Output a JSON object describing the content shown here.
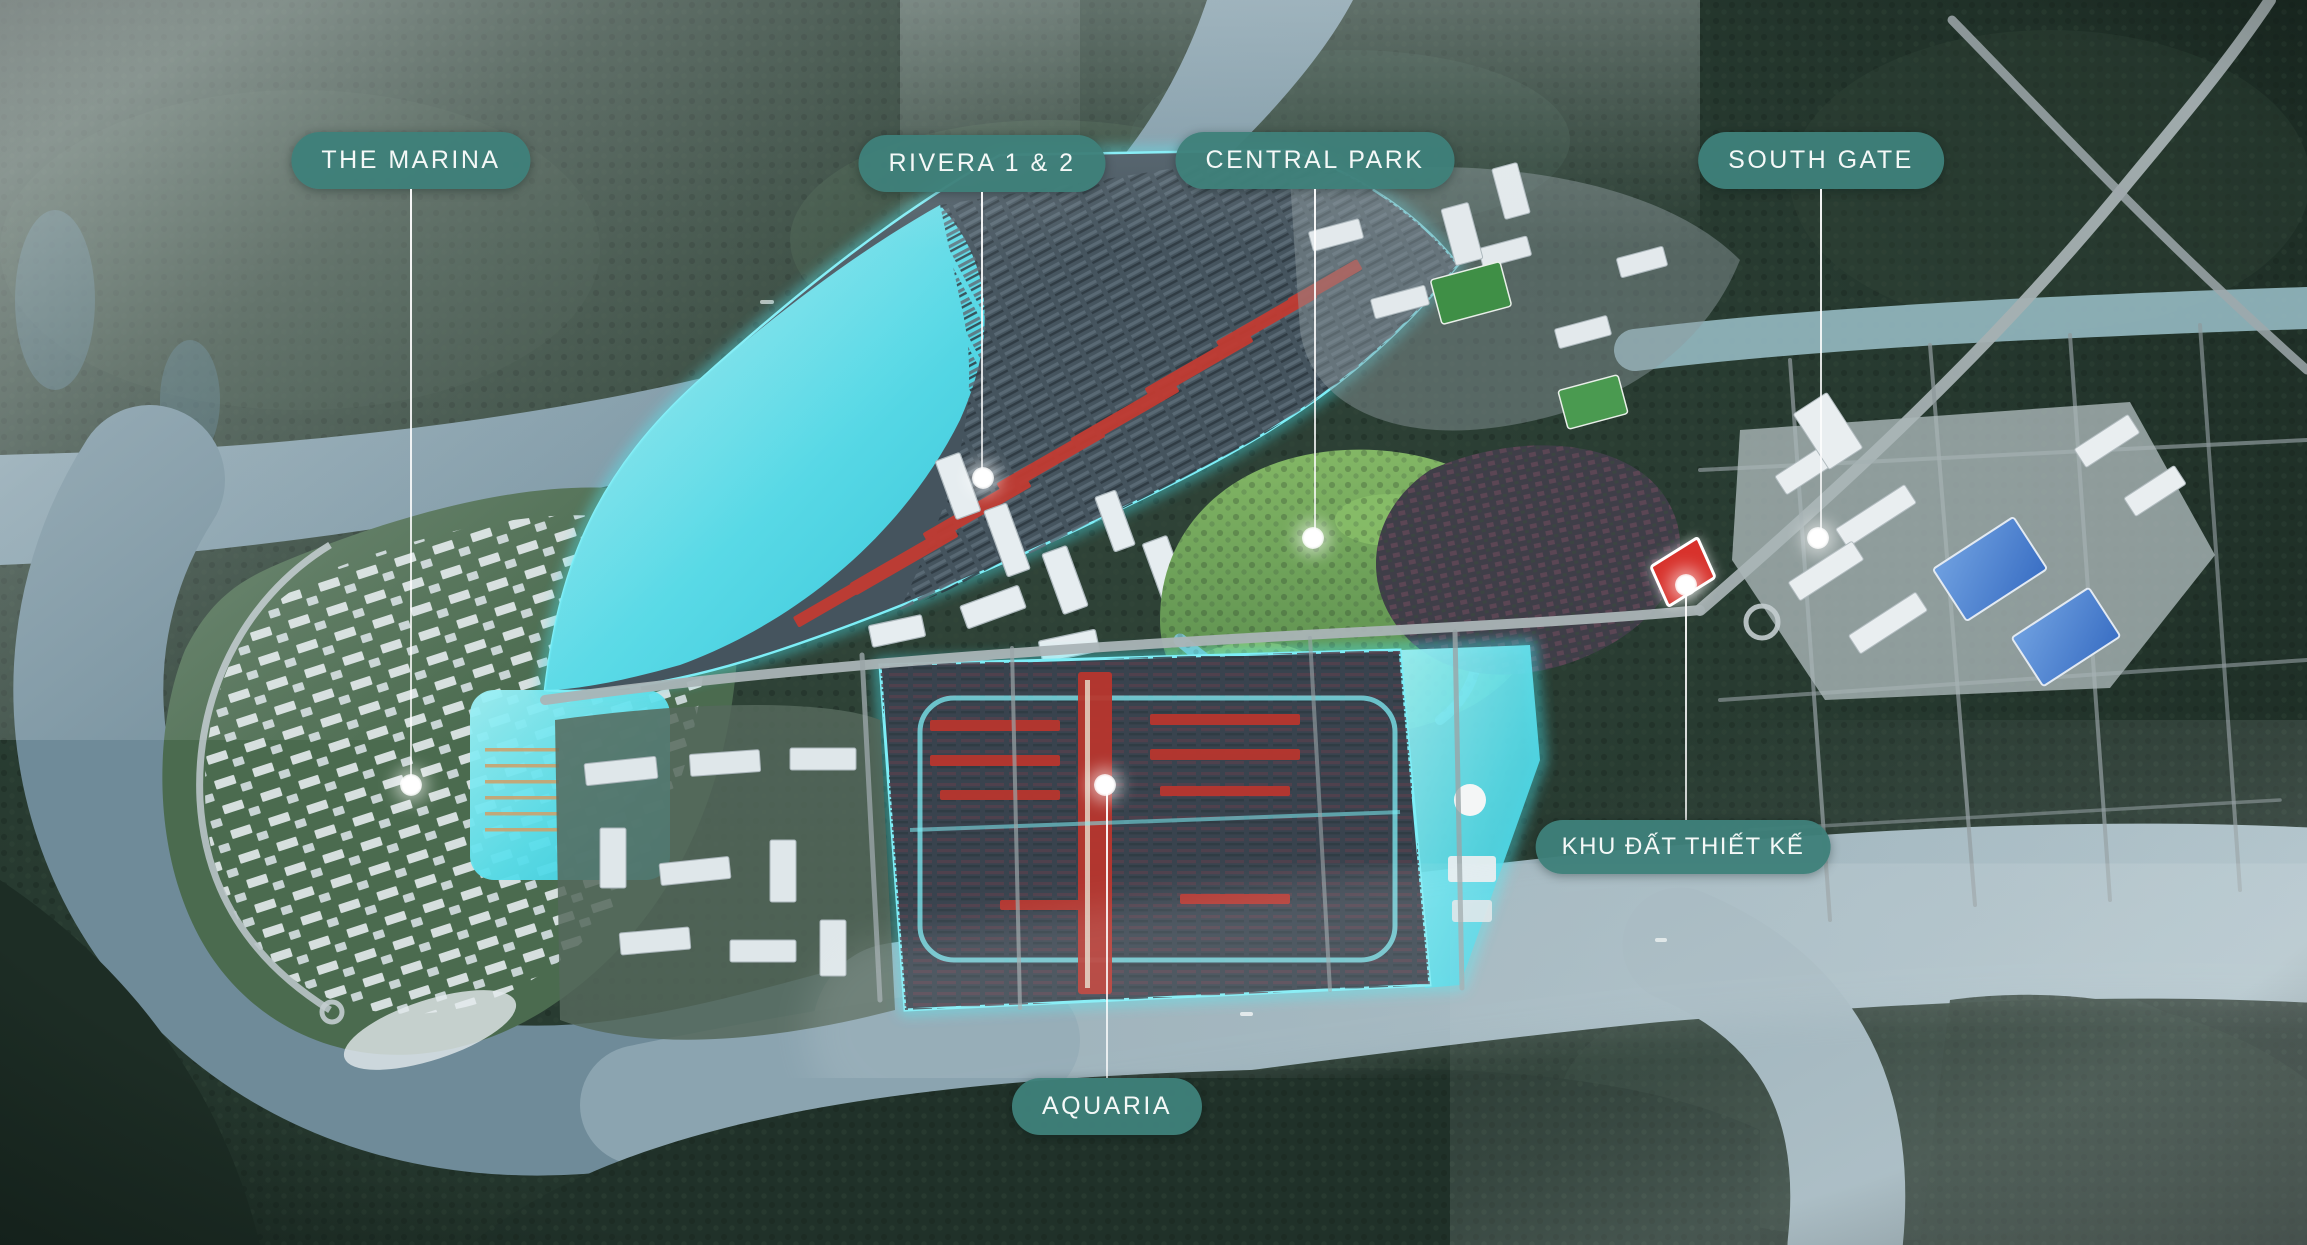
{
  "callouts": [
    {
      "id": "the-marina",
      "label": "THE MARINA"
    },
    {
      "id": "rivera-1-2",
      "label": "RIVERA 1 & 2"
    },
    {
      "id": "central-park",
      "label": "CENTRAL PARK"
    },
    {
      "id": "south-gate",
      "label": "SOUTH GATE"
    },
    {
      "id": "khu-dat-thiet-ke",
      "label": "KHU ĐẤT THIẾT KẾ"
    },
    {
      "id": "aquaria",
      "label": "AQUARIA"
    }
  ],
  "colors": {
    "pill_background": "#3E807A",
    "pill_text": "#FFFFFF",
    "leader_line": "#FFFFFF",
    "district_highlight_cyan": "#45E6F2",
    "design_plot_red": "#D8322C",
    "river": "#7E99A6",
    "forest": "#22332B"
  }
}
